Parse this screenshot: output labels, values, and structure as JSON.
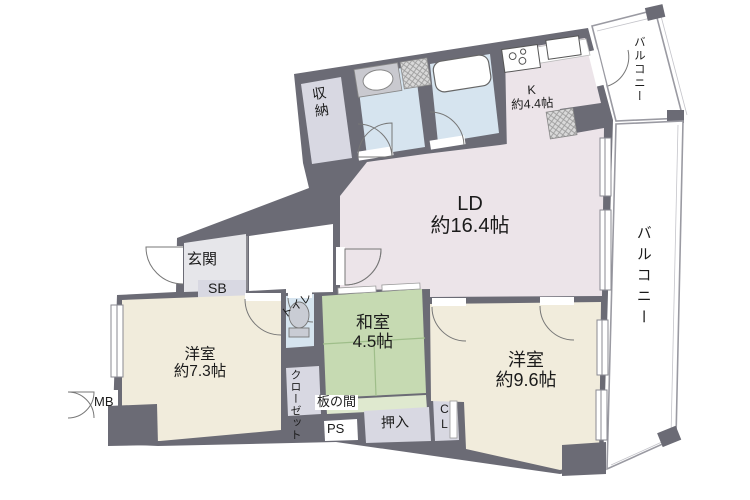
{
  "plan": {
    "ld": {
      "name": "LD",
      "size": "約16.4帖"
    },
    "kitchen": {
      "name": "K",
      "size": "約4.4帖"
    },
    "tatami_room": {
      "name": "和室",
      "size": "4.5帖"
    },
    "bedroom_73": {
      "name": "洋室",
      "size": "約7.3帖"
    },
    "bedroom_96": {
      "name": "洋室",
      "size": "約9.6帖"
    },
    "entrance_label": "玄関",
    "storage_label": "収納",
    "toilet_label": "トイレ",
    "closet_label": "クローゼット",
    "wooden_floor_label": "板の間",
    "futon_closet_label": "押入",
    "balcony_top_label": "バルコニー",
    "balcony_right_label": "バルコニー",
    "shoe_box_label": "SB",
    "meter_box_label": "MB",
    "pipe_space_label": "PS",
    "closet_cl_label": "CL"
  },
  "colors": {
    "wall": "#6b6b75",
    "living_floor": "#ece4e9",
    "sanitary_floor": "#d6e4ef",
    "tatami_floor": "#c6dab2",
    "tatami_line": "#9fbe8a",
    "bedroom_floor": "#f1ecdc",
    "closet_floor": "#d8d8e2",
    "entrance_floor": "#e6e6ea",
    "wooden_strip": "#dfe9cf",
    "balcony_line": "#9a9aa2",
    "door_line": "#777777"
  }
}
